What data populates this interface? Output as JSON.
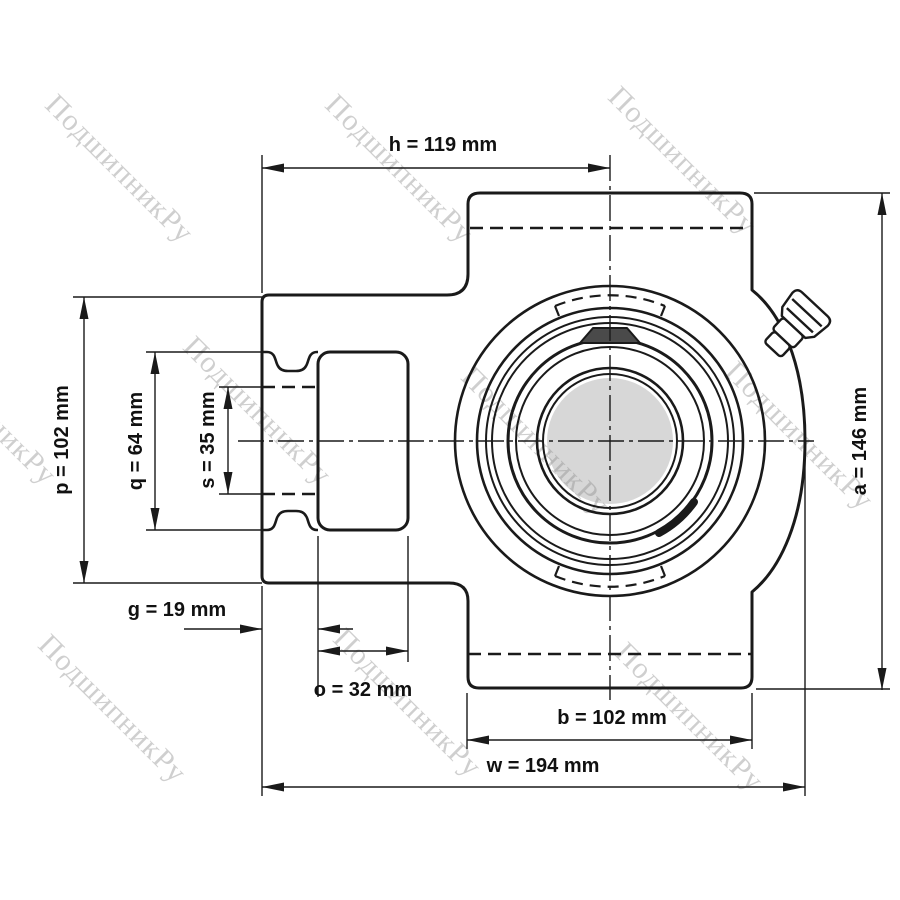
{
  "page": {
    "background": "#ffffff",
    "line_color": "#1a1a1a",
    "label_color": "#111111"
  },
  "watermark": {
    "text": "ПодшипникРу",
    "color": "#cfcfcf"
  },
  "drawing": {
    "subject": "take-up bearing unit housing outline drawing with dimensions",
    "units": "mm",
    "colors": {
      "bore_fill": "rgba(140,140,140,0.35)",
      "set_screw_fill": "#4a4a4a"
    },
    "dimensions": {
      "h": {
        "param": "h",
        "value_mm": 119,
        "label": "h = 119 mm"
      },
      "p": {
        "param": "p",
        "value_mm": 102,
        "label": "p = 102 mm"
      },
      "q": {
        "param": "q",
        "value_mm": 64,
        "label": "q = 64 mm"
      },
      "s": {
        "param": "s",
        "value_mm": 35,
        "label": "s = 35 mm"
      },
      "g": {
        "param": "g",
        "value_mm": 19,
        "label": "g = 19 mm"
      },
      "o": {
        "param": "o",
        "value_mm": 32,
        "label": "o = 32 mm"
      },
      "b": {
        "param": "b",
        "value_mm": 102,
        "label": "b = 102 mm"
      },
      "w": {
        "param": "w",
        "value_mm": 194,
        "label": "w = 194 mm"
      },
      "a": {
        "param": "a",
        "value_mm": 146,
        "label": "a = 146 mm"
      }
    }
  }
}
